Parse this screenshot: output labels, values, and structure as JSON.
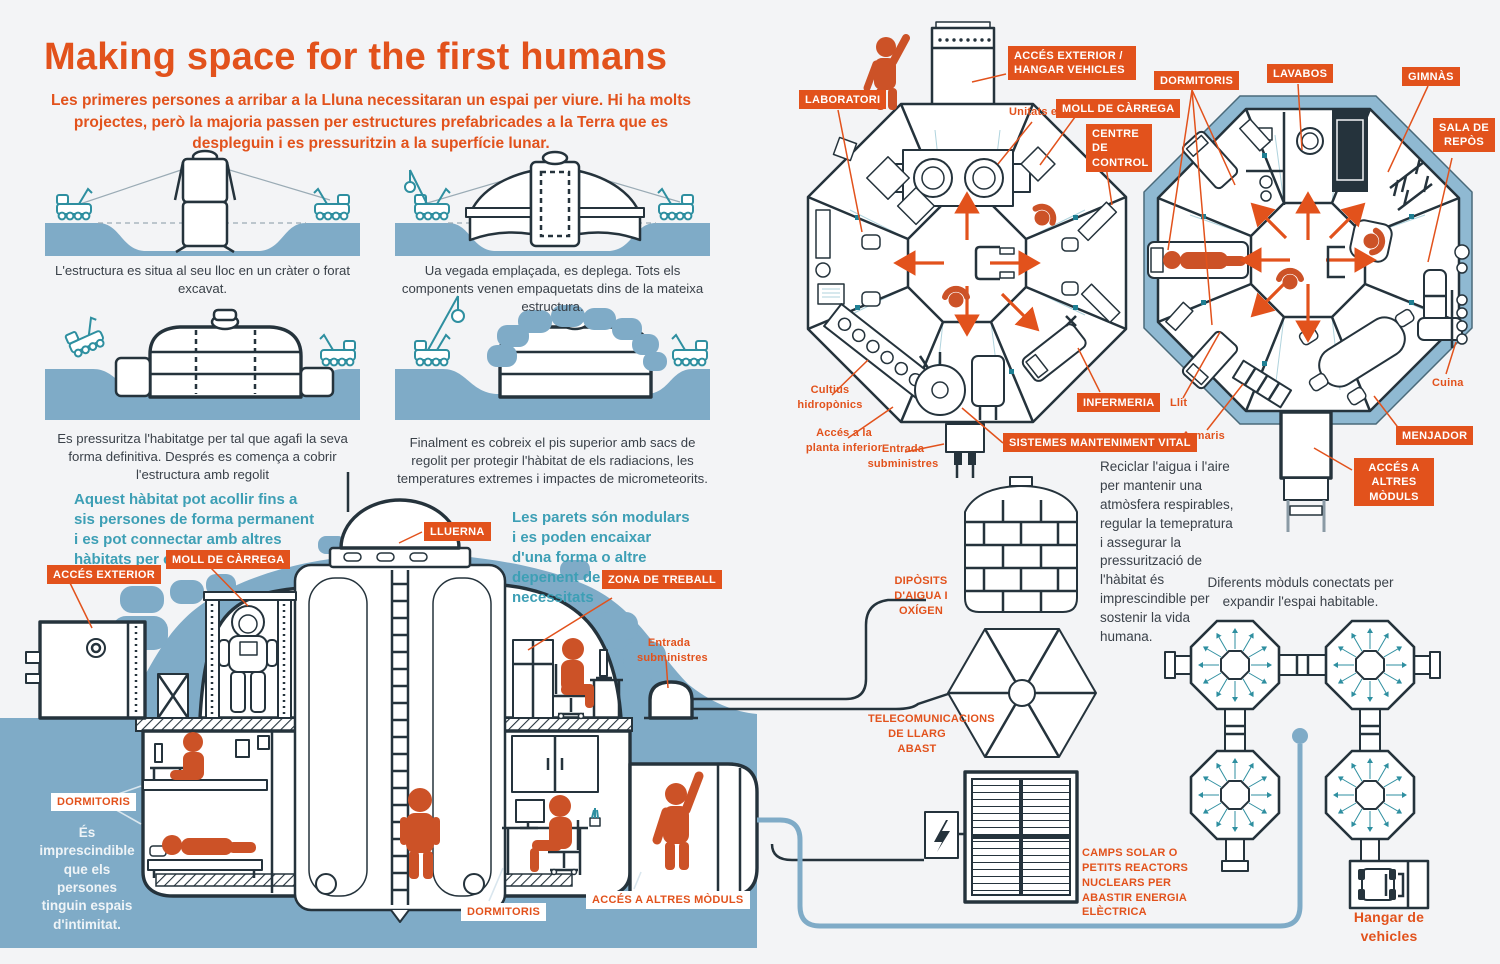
{
  "header": {
    "title": "Making space for the first humans",
    "intro": "Les primeres persones a arribar a la Lluna necessitaran un espai per viure. Hi ha molts projectes, però la majoria passen per estructures prefabricades a la Terra que es despleguin i es pressuritzin a la superfície lunar."
  },
  "steps": {
    "captions": [
      "L'estructura es situa al seu lloc en un cràter o forat excavat.",
      "Ua vegada emplaçada, es deplega. Tots els components venen empaquetats dins de la mateixa estructura.",
      "Es pressuritza l'habitatge per tal que agafi la seva forma definitiva. Després es comença a cobrir l'estructura amb regolit",
      "Finalment es cobreix el pis superior amb sacs de regolit per protegir l'hàbitat de els radiacions, les temperatures extremes i impactes de micrometeorits."
    ]
  },
  "notes": {
    "capacity": "Aquest hàbitat pot acollir fins a sis persones de forma permanent i es pot connectar amb altres hàbitats per crear una petita comunitat.",
    "walls": "Les parets són modulars i es poden encaixar d'una forma o altre depenent de les necessitats",
    "privacy": "És imprescindible que els persones tinguin espais d'intimitat.",
    "life_support": "Reciclar l'aigua i l'aire per mantenir una atmòsfera respirables, regular la temepratura i assegurar la pressurització de l'hàbitat és imprescindible per sostenir la vida humana.",
    "expansion": "Diferents mòduls conectats per expandir l'espai habitable."
  },
  "cross_section": {
    "acces_exterior": "ACCÉS EXTERIOR",
    "moll_carrega": "MOLL DE CÀRREGA",
    "lluerna": "LLUERNA",
    "zona_treball": "ZONA DE TREBALL",
    "entrada_subministres": "Entrada subministres",
    "dormitoris": "DORMITORIS",
    "dormitoris_2": "DORMITORIS",
    "acces_altres_moduls": "ACCÉS A ALTRES MÒDULS"
  },
  "plan_upper": {
    "laboratori": "LABORATORI",
    "acces_hangar": "ACCÉS EXTERIOR / HANGAR VEHICLES",
    "unitats_extravehiculars": "Unitats extravehiculars",
    "moll_carrega": "MOLL DE CÀRREGA",
    "centre_control": "CENTRE DE CONTROL",
    "infermeria": "INFERMERIA",
    "sistemes": "SISTEMES MANTENIMENT VITAL",
    "cultius": "Cultius hidropònics",
    "acces_planta": "Accés a la planta inferior",
    "entrada_subministres": "Entrada subministres"
  },
  "plan_lower": {
    "dormitoris": "DORMITORIS",
    "lavabos": "LAVABOS",
    "gimnas": "GIMNÀS",
    "sala_repos": "SALA DE REPÒS",
    "menjador": "MENJADOR",
    "acces_altres": "ACCÉS A ALTRES MÒDULS",
    "llit": "Llit",
    "armaris": "Armaris",
    "cuina": "Cuina"
  },
  "systems": {
    "diposits": "DIPÒSITS D'AIGUA I OXÍGEN",
    "telecom": "TELECOMUNICACIONS DE LLARG ABAST",
    "energia": "CAMPS SOLAR O PETITS REACTORS NUCLEARS PER ABASTIR ENERGIA ELÈCTRICA",
    "hangar": "Hangar de vehicles"
  },
  "colors": {
    "accent_orange": "#E2521C",
    "figure_orange": "#CC5227",
    "teal_text": "#3D9FB5",
    "ground_blue": "#7FABC7",
    "line_dark": "#25333C",
    "rover_teal": "#2E8FA0",
    "plan_ring_blue": "#8FB9D2",
    "background": "#F3F4F6"
  }
}
